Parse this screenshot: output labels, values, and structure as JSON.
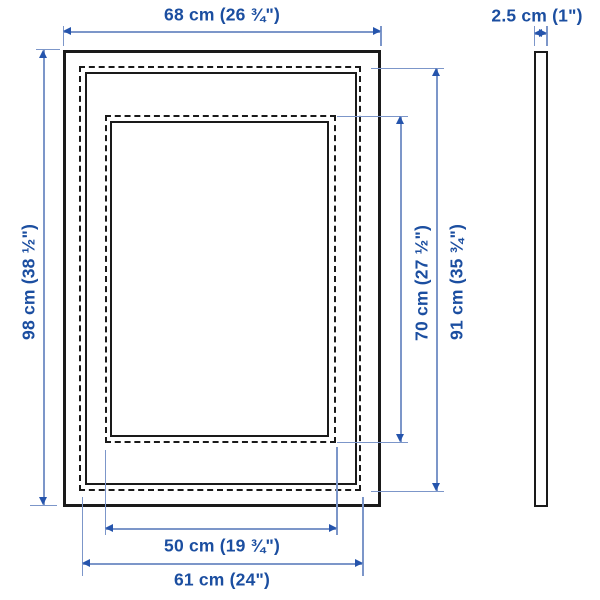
{
  "diagram": {
    "product": "picture frame dimension diagram",
    "front_view": {
      "dimensions": {
        "outer_width": "68 cm (26 ¾\")",
        "outer_height": "98 cm (38 ½\")",
        "picture_height": "70 cm (27 ½\")",
        "back_height": "91 cm (35 ¾\")",
        "picture_width": "50 cm (19 ¾\")",
        "back_width": "61 cm (24\")"
      }
    },
    "side_view": {
      "depth": "2.5 cm (1\")"
    },
    "colors": {
      "label_text": "#1b4ea0",
      "dimension_line": "#7c96c9",
      "arrowhead": "#2554ac",
      "frame_outline": "#1a1a1a",
      "background": "#ffffff"
    }
  }
}
